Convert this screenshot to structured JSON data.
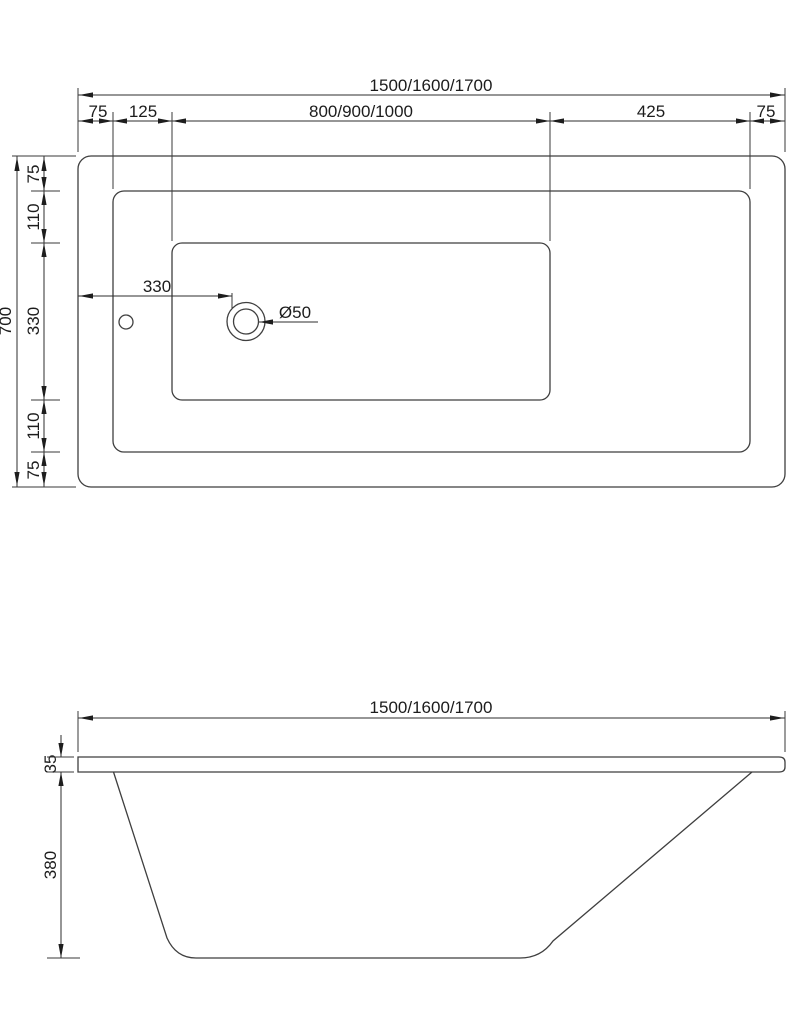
{
  "top_view": {
    "overall_width": "1500/1600/1700",
    "width_segments": [
      "75",
      "125",
      "800/900/1000",
      "425",
      "75"
    ],
    "overall_depth": "700",
    "depth_segments": [
      "75",
      "110",
      "330",
      "110",
      "75"
    ],
    "drain_offset": "330",
    "drain_diameter": "Ø50"
  },
  "side_view": {
    "overall_length": "1500/1600/1700",
    "rim_thickness": "35",
    "body_depth": "380"
  },
  "colors": {
    "background": "#ffffff",
    "object_line": "#3f3f3f",
    "dimension_line": "#2e2e2e",
    "text": "#1c1c1c"
  }
}
